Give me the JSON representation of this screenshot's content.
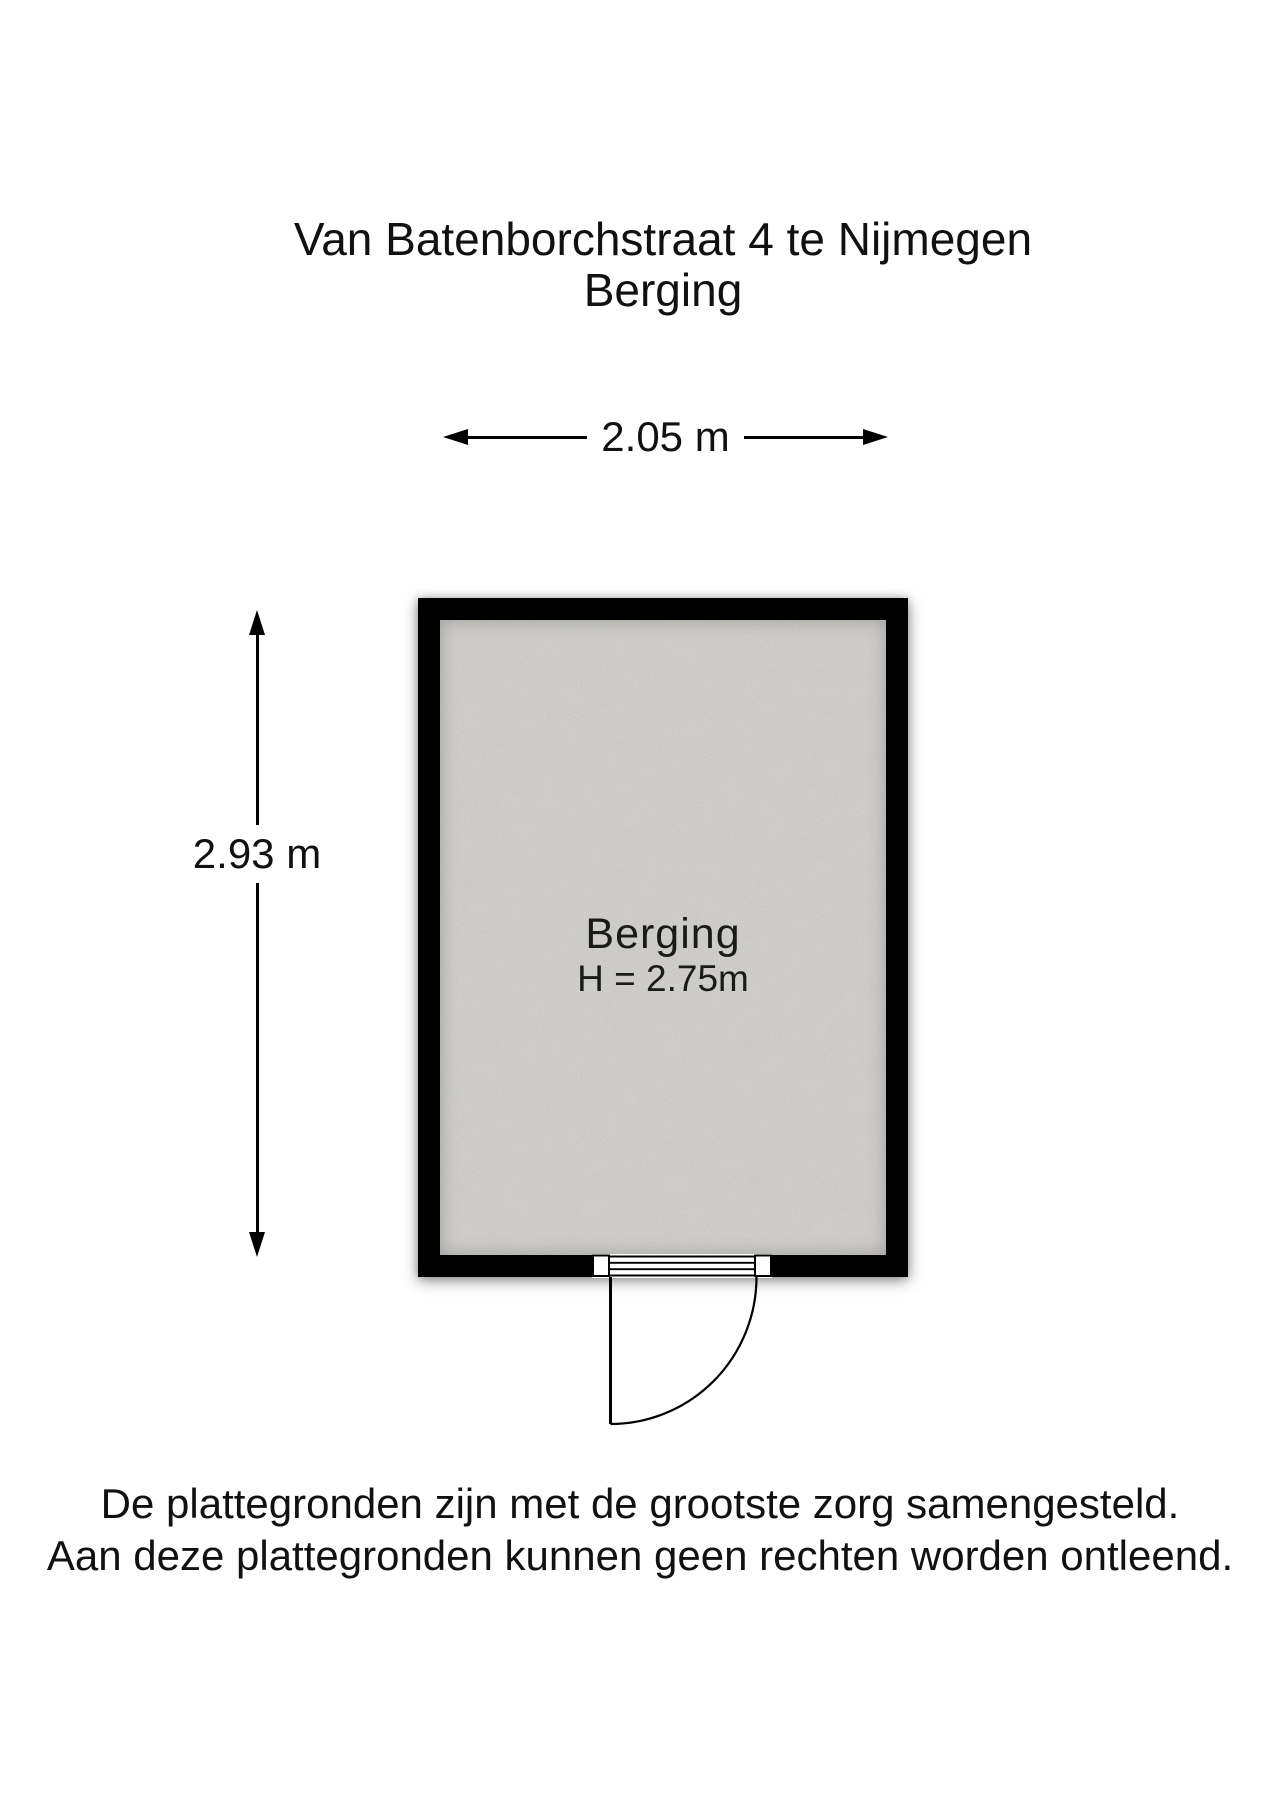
{
  "title": {
    "address": "Van Batenborchstraat 4 te Nijmegen",
    "room_type": "Berging"
  },
  "dimensions": {
    "width": "2.05 m",
    "height": "2.93 m"
  },
  "room": {
    "label": "Berging",
    "ceiling_height": "H = 2.75m"
  },
  "footer": {
    "line1": "De plattegronden zijn met de grootste zorg samengesteld.",
    "line2": "Aan deze plattegronden kunnen geen rechten worden ontleend."
  },
  "colors": {
    "wall": "#000000",
    "floor": "#d6d5d2",
    "text": "#111111"
  }
}
